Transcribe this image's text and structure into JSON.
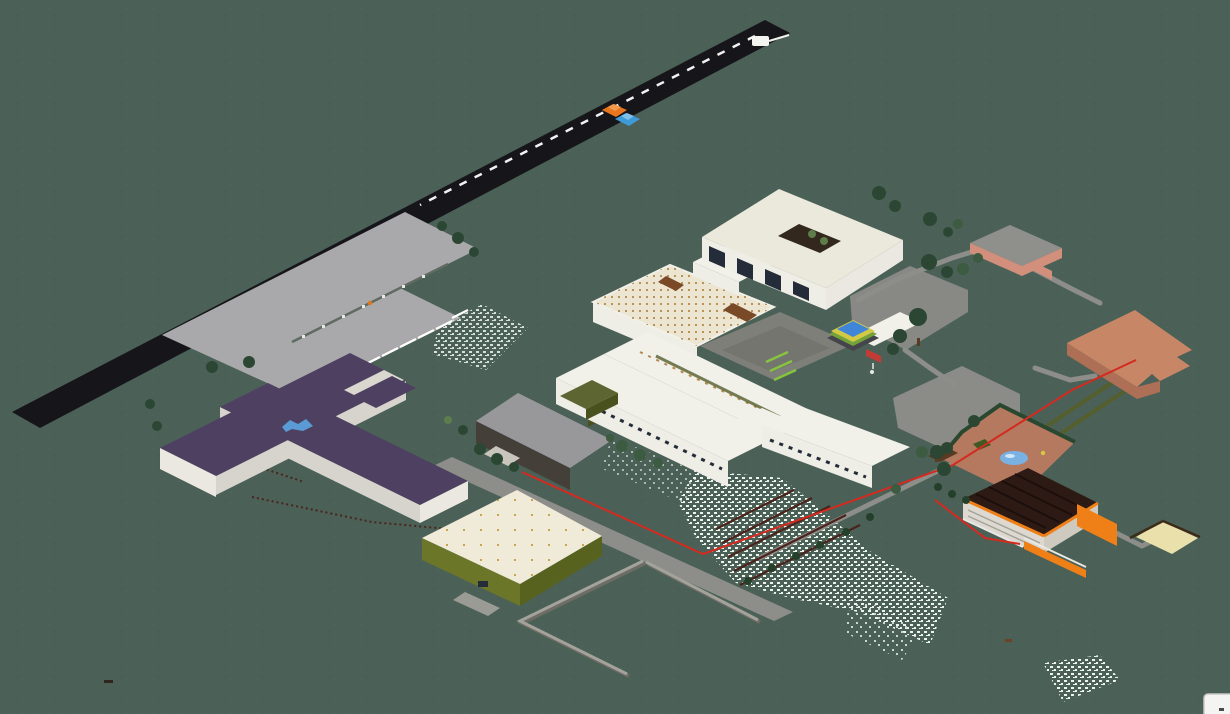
{
  "scene": {
    "title": "Isometric voxel render of a school campus",
    "view": "isometric 2:1",
    "no_text_on_screen": true
  },
  "features": {
    "road": {
      "label": "asphalt road",
      "dashed_center_line": true
    },
    "vehicles": [
      {
        "type": "car",
        "color_name": "orange"
      },
      {
        "type": "car",
        "color_name": "blue"
      },
      {
        "type": "truck",
        "color_name": "white"
      }
    ],
    "parking_lot": {
      "label": "parking lot",
      "stall_marks": 9,
      "median_island": true,
      "lamp": 1
    },
    "buildings": [
      {
        "id": "purple-cross-building",
        "roof": "dark purple",
        "walls": "white",
        "wings": 4,
        "roof_graffiti": "blue"
      },
      {
        "id": "gray-roof-hall",
        "roof": "gray",
        "walls": "dark brown",
        "annex": "olive"
      },
      {
        "id": "main-complex",
        "roof": "white",
        "details": [
          "dotted skylight roof",
          "gray inner courtyard",
          "lime stairs",
          "window rows"
        ]
      },
      {
        "id": "courtyard-block",
        "roof": "white",
        "atrium_trees": 2,
        "window_bays": 4
      },
      {
        "id": "green-hall",
        "walls": "olive green",
        "roof": "cream with vent dots",
        "loading_dock": true
      },
      {
        "id": "small-salmon-building",
        "walls": "salmon",
        "roof": "gray"
      },
      {
        "id": "large-salmon-building",
        "roof": "salmon"
      },
      {
        "id": "barn",
        "roof": "dark brown",
        "trim": "orange",
        "rails": "white"
      }
    ],
    "garden": {
      "paving": "terracotta",
      "pond": true,
      "hedges": true,
      "hut": true,
      "flowerbed": true
    },
    "sand_pit": {
      "border": "dark brown"
    },
    "flower_patches": 4,
    "terrace_steps": 5,
    "enclosure_walls": 3,
    "red_utility_line": true,
    "dotted_fence_lines": 2,
    "corner_card": {
      "visible": true
    }
  },
  "colors": {
    "background": "#4b6157",
    "grass_dark": "#41584c",
    "grass_light": "#567061",
    "road": "#16161a",
    "road_dash": "#f2f2f2",
    "parking": "#a9a9ac",
    "parking_mark": "#ffffff",
    "median": "#5f6b60",
    "median_dot": "#e8e8e8",
    "lamp_orange": "#e07818",
    "purple_roof": "#4e4060",
    "purple_gap": "#d9d7d0",
    "wall_light": "#eae8e1",
    "wall_mid": "#d6d4cd",
    "blue_splash": "#5b9bd5",
    "gym_roof": "#98989b",
    "gym_wall": "#453f39",
    "gym_entry": "#c9c5bc",
    "olive_roof": "#5d6532",
    "olive_dark": "#49511f",
    "complex_wall": "#eeede6",
    "complex_roof": "#f1f0e9",
    "cream_roof": "#ece5d2",
    "roof_dot": "#b5894c",
    "block_roof": "#ebe9dc",
    "window_dark": "#232c38",
    "atrium_dark": "#32281e",
    "courtyard_gray": "#7f7f7a",
    "courtyard_shade": "#6e6e69",
    "lime": "#86c440",
    "olive_strip": "#555f2e",
    "pergola_brown": "#7a4a28",
    "greenhouse_wall": "#6b7629",
    "greenhouse_wall_dark": "#57621f",
    "greenhouse_roof": "#f0ead9",
    "roof_dot_sparse": "#c9a44a",
    "dock_gray": "#9b9b95",
    "salmon_wall": "#d18f7c",
    "salmon_roof_top": "#8f8f8c",
    "terracotta_roof": "#c78767",
    "terracotta_wall": "#ad6f55",
    "garden_paving": "#b5795f",
    "hedge": "#2a472f",
    "pond": "#79b1e3",
    "pond_light": "#cfe6f7",
    "flowerbed": "#3e5a22",
    "hut_roof": "#5a3a22",
    "barn_roof": "#2d1a14",
    "barn_ridge": "#1c0f0b",
    "barn_wall": "#ded9d0",
    "barn_wall_side": "#cfcabf",
    "orange_trim": "#ef7f17",
    "rail_white": "#e8e8e4",
    "path": "#8d8d89",
    "plaza": "#8b8b87",
    "wall_gray": "#a3a39c",
    "wall_gray_shadow": "#6d6d66",
    "red_line": "#d42a20",
    "fence_dots": "#4a241c",
    "sand": "#e9e0ac",
    "sand_border": "#3c2b18",
    "speckle": "#edf4ee",
    "tree_dark": "#2b4733",
    "tree_mid": "#3c5b40",
    "tree_light": "#5d7d4a",
    "trunk": "#5b3a22",
    "bush": "#24402a",
    "car_orange": "#e8761f",
    "car_orange_cab": "#f19a4d",
    "car_blue": "#3f9ad8",
    "car_blue_cab": "#7fc0ea",
    "truck": "#f3f3ef",
    "pool_base": "#44444a",
    "pool_green": "#74a23a",
    "pool_yellow": "#d4c944",
    "pool_blue": "#3f86d8",
    "sign_red": "#c23b35",
    "dirt": "#6b4226",
    "speck_dark": "#30251c",
    "card_bg": "#f4f4f2",
    "card_border": "#c8c8c4",
    "card_mark": "#4a4a46"
  }
}
